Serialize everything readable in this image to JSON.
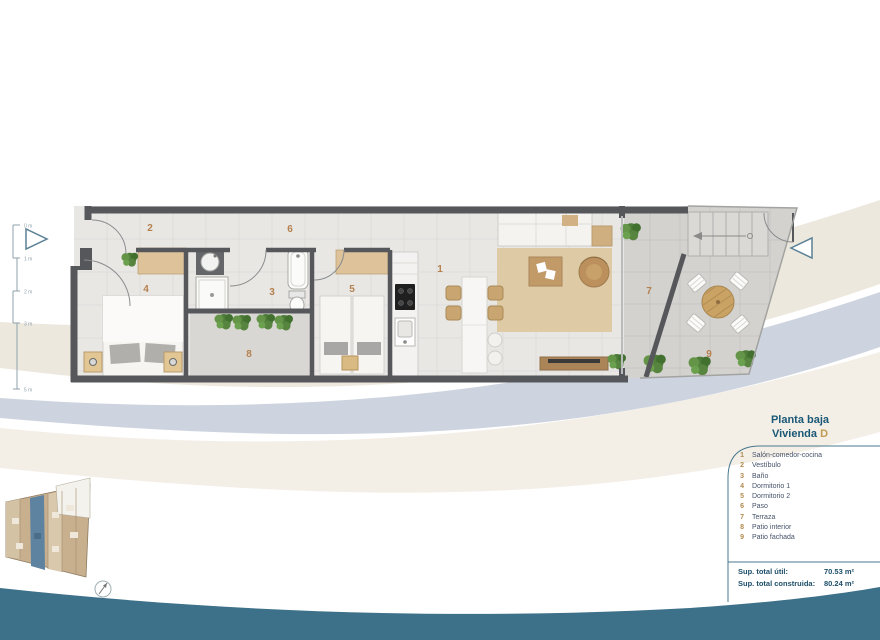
{
  "page": {
    "titles": {
      "line1": "Planta baja",
      "line2": "Vivienda",
      "unit": "D"
    }
  },
  "plan": {
    "rooms": [
      {
        "num": "1",
        "label": "Salón-comedor-cocina"
      },
      {
        "num": "2",
        "label": "Vestíbulo"
      },
      {
        "num": "3",
        "label": "Baño"
      },
      {
        "num": "4",
        "label": "Dormitorio 1"
      },
      {
        "num": "5",
        "label": "Dormitorio 2"
      },
      {
        "num": "6",
        "label": "Paso"
      },
      {
        "num": "7",
        "label": "Terraza"
      },
      {
        "num": "8",
        "label": "Patio interior"
      },
      {
        "num": "9",
        "label": "Patio fachada"
      }
    ],
    "scale_labels": [
      "0 m",
      "1 m",
      "2 m",
      "3 m",
      "5 m"
    ]
  },
  "totals": [
    {
      "label": "Sup. total útil:",
      "value": "70.53 m²"
    },
    {
      "label": "Sup. total construida:",
      "value": "80.24 m²"
    }
  ],
  "colors": {
    "wave_teal": "#3d7089",
    "title_blue": "#1a5877",
    "accent_gold": "#c09a4f",
    "room_number": "#b5814f",
    "wall_gray": "#56575b",
    "band_blue": "#cdd4df",
    "band_cream": "#ede8dd"
  }
}
